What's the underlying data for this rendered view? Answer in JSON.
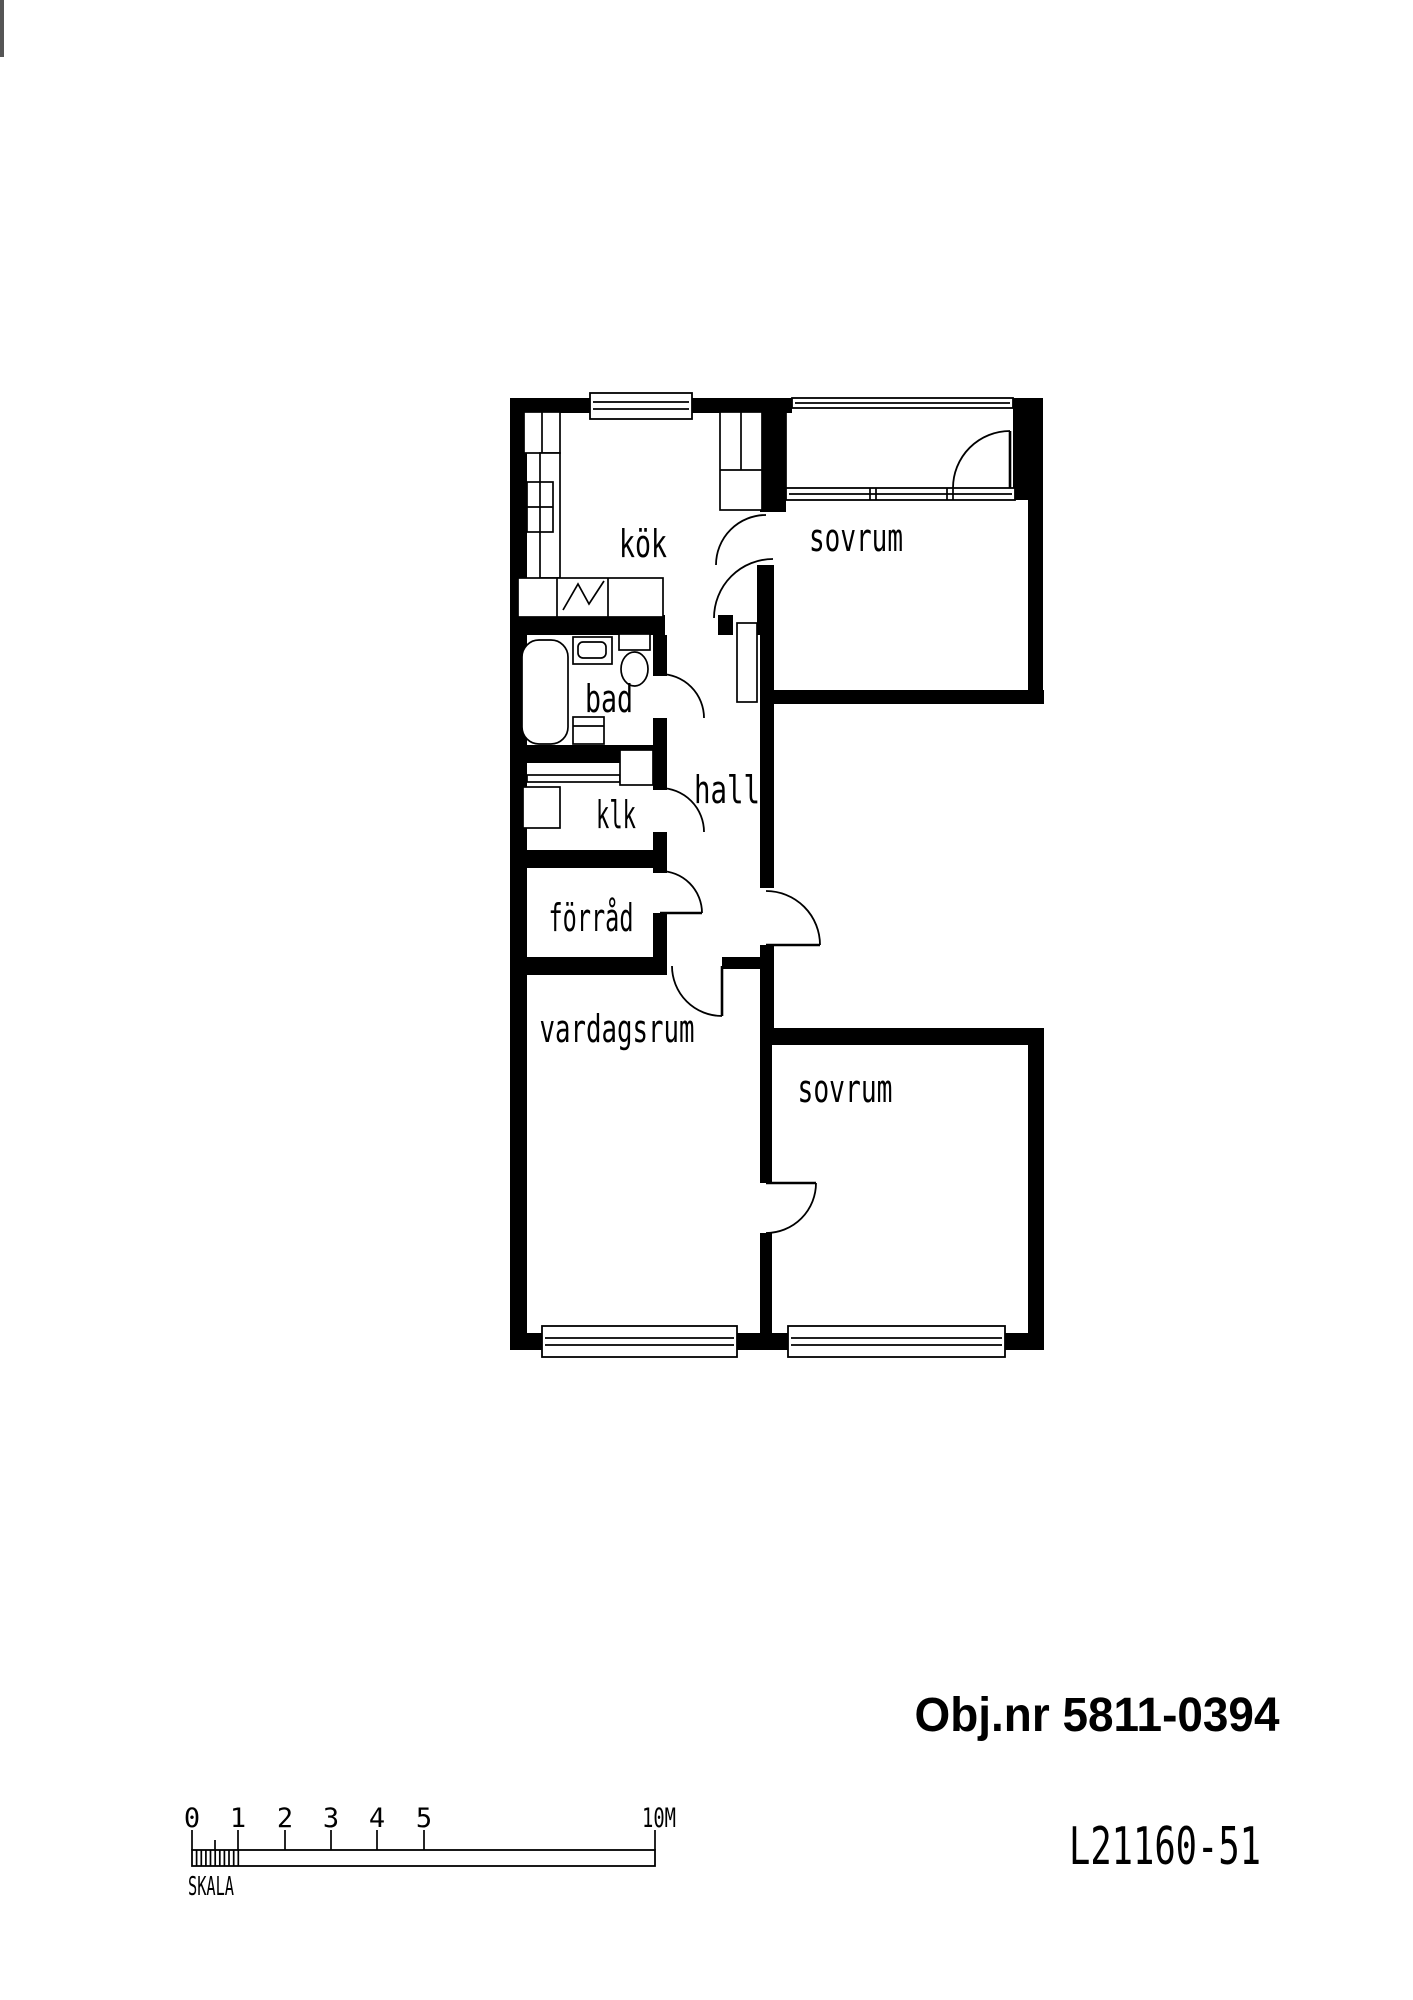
{
  "texts": {
    "object_number": "Obj.nr 5811-0394",
    "drawing_id": "L21160-51"
  },
  "scale_bar": {
    "label": "SKALA",
    "tick_labels": [
      "0",
      "1",
      "2",
      "3",
      "4",
      "5"
    ],
    "end_label": "10M"
  },
  "floor_plan": {
    "room_labels": [
      {
        "id": "kok",
        "label": "kök"
      },
      {
        "id": "sovrum_top",
        "label": "sovrum"
      },
      {
        "id": "bad",
        "label": "bad"
      },
      {
        "id": "hall",
        "label": "hall"
      },
      {
        "id": "klk",
        "label": "klk"
      },
      {
        "id": "forrad",
        "label": "förråd"
      },
      {
        "id": "vardagsrum",
        "label": "vardagsrum"
      },
      {
        "id": "sovrum_bottom",
        "label": "sovrum"
      }
    ],
    "colors": {
      "line": "#000000",
      "background": "#ffffff"
    }
  }
}
